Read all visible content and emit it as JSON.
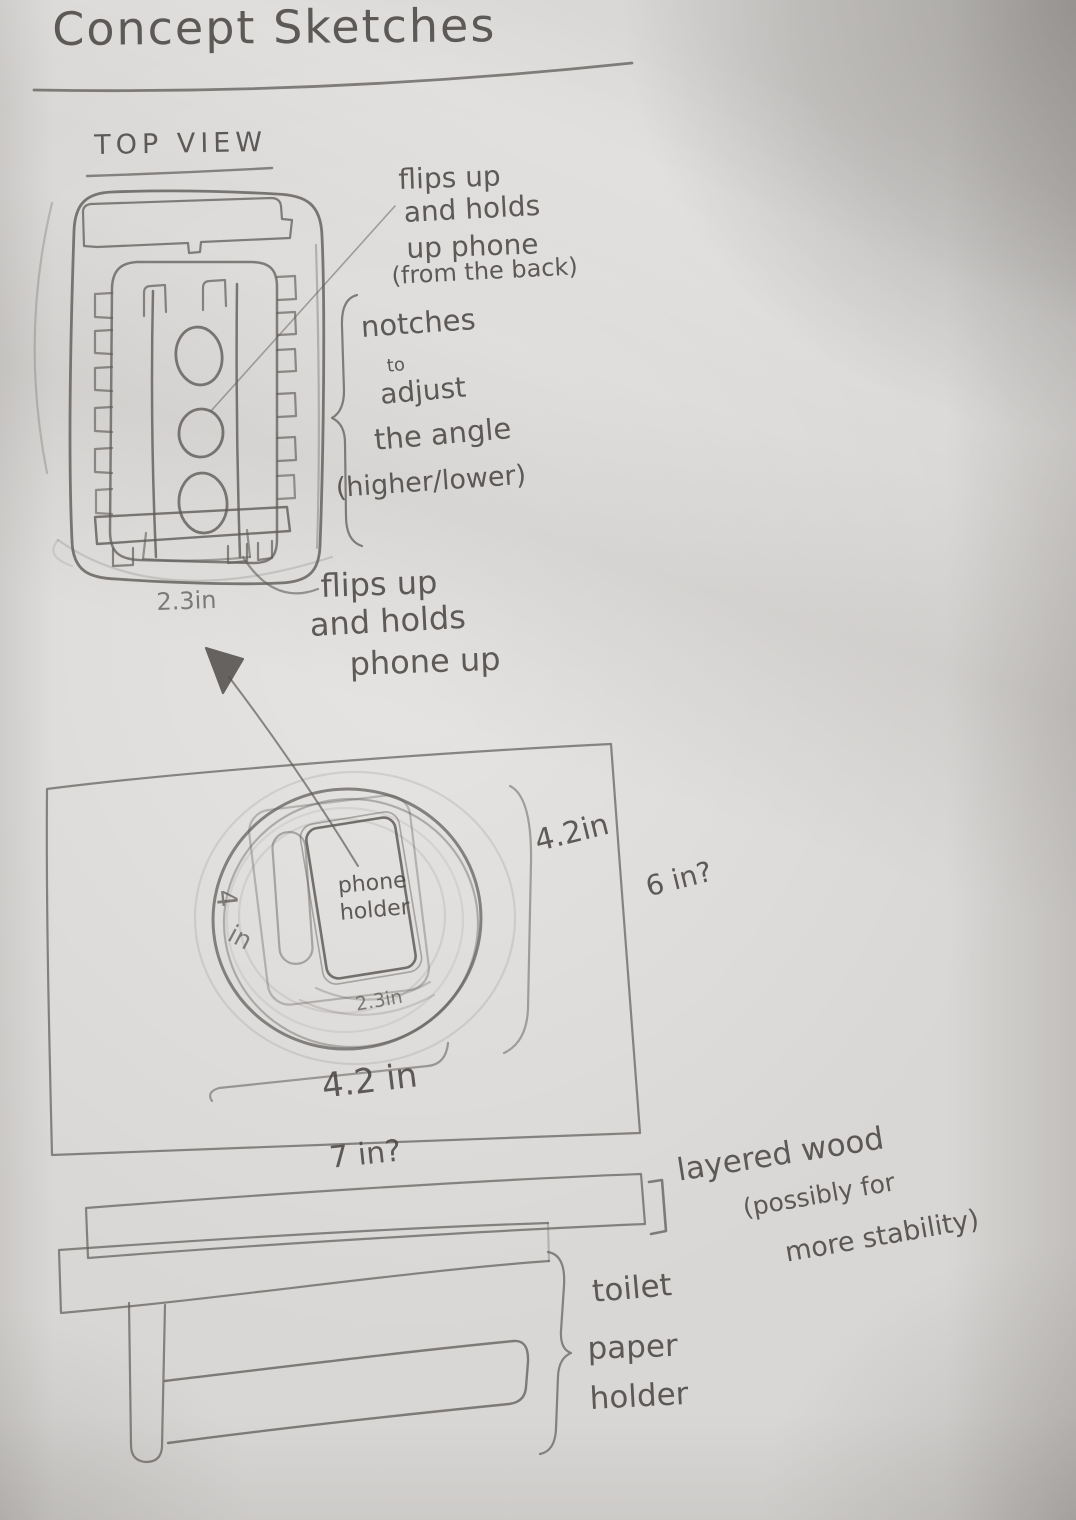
{
  "title": "Concept Sketches",
  "top_view": {
    "heading": "TOP VIEW",
    "note_flip_top": [
      "flips up",
      "and holds",
      "up phone",
      "(from the back)"
    ],
    "note_notches": [
      "notches",
      "to",
      "adjust",
      "the angle",
      "(higher/lower)"
    ],
    "note_flip_bottom": [
      "flips up",
      "and holds",
      "phone up"
    ],
    "dim_width": "2.3in"
  },
  "base_view": {
    "phone_label": [
      "phone",
      "holder"
    ],
    "dim_height": [
      "4",
      "in"
    ],
    "dim_phone_width": "2.3in",
    "dim_circle_right": "4.2in",
    "dim_base_width": "6 in?",
    "dim_circle_bottom": "4.2 in",
    "dim_base_length": "7 in?"
  },
  "side_view": {
    "note_layered_wood": [
      "layered wood",
      "(possibly for",
      "more stability)"
    ],
    "note_toilet_paper": [
      "toilet",
      "paper",
      "holder"
    ]
  },
  "colors": {
    "pencil": "#5f5c59",
    "paper": "#e6e4e3"
  }
}
